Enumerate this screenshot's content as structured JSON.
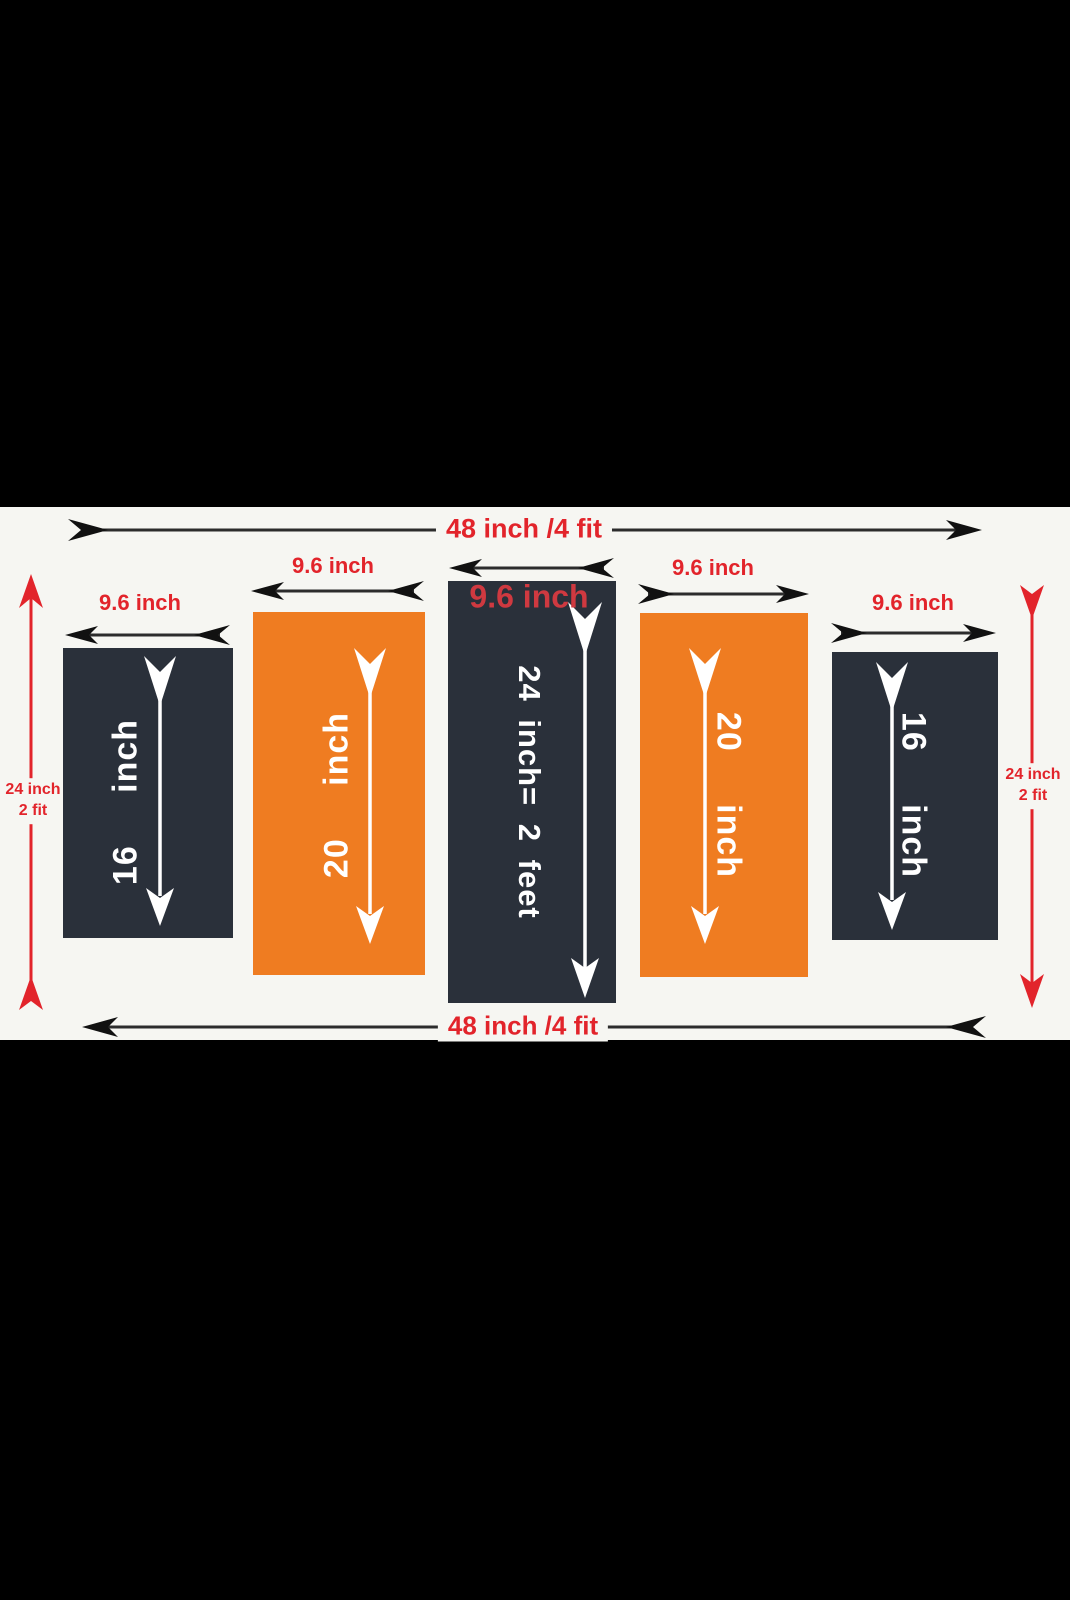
{
  "figure": {
    "overall_width_top": "48 inch /4 fit",
    "overall_width_bottom": "48 inch /4 fit",
    "left_height": {
      "line1": "24 inch",
      "line2": "2 fit"
    },
    "right_height": {
      "line1": "24 inch",
      "line2": "2 fit"
    },
    "panels": [
      {
        "id": "panel-1",
        "width_label": "9.6 inch",
        "height_label": "16 inch",
        "color": "#2a303a"
      },
      {
        "id": "panel-2",
        "width_label": "9.6 inch",
        "height_label": "20 inch",
        "color": "#ef7c21"
      },
      {
        "id": "panel-3",
        "width_label": "9.6 inch",
        "height_label": "24 inch= 2 feet",
        "color": "#2a303a"
      },
      {
        "id": "panel-4",
        "width_label": "9.6 inch",
        "height_label": "20 inch",
        "color": "#ef7c21"
      },
      {
        "id": "panel-5",
        "width_label": "9.6 inch",
        "height_label": "16 inch",
        "color": "#2a303a"
      }
    ],
    "colors": {
      "accent_red": "#e2242b",
      "panel_dark": "#2a303a",
      "panel_orange": "#ef7c21",
      "canvas_background": "#f6f6f2",
      "letterbox": "#000000",
      "arrow_black": "#1f1f1f",
      "arrow_white": "#ffffff"
    }
  }
}
